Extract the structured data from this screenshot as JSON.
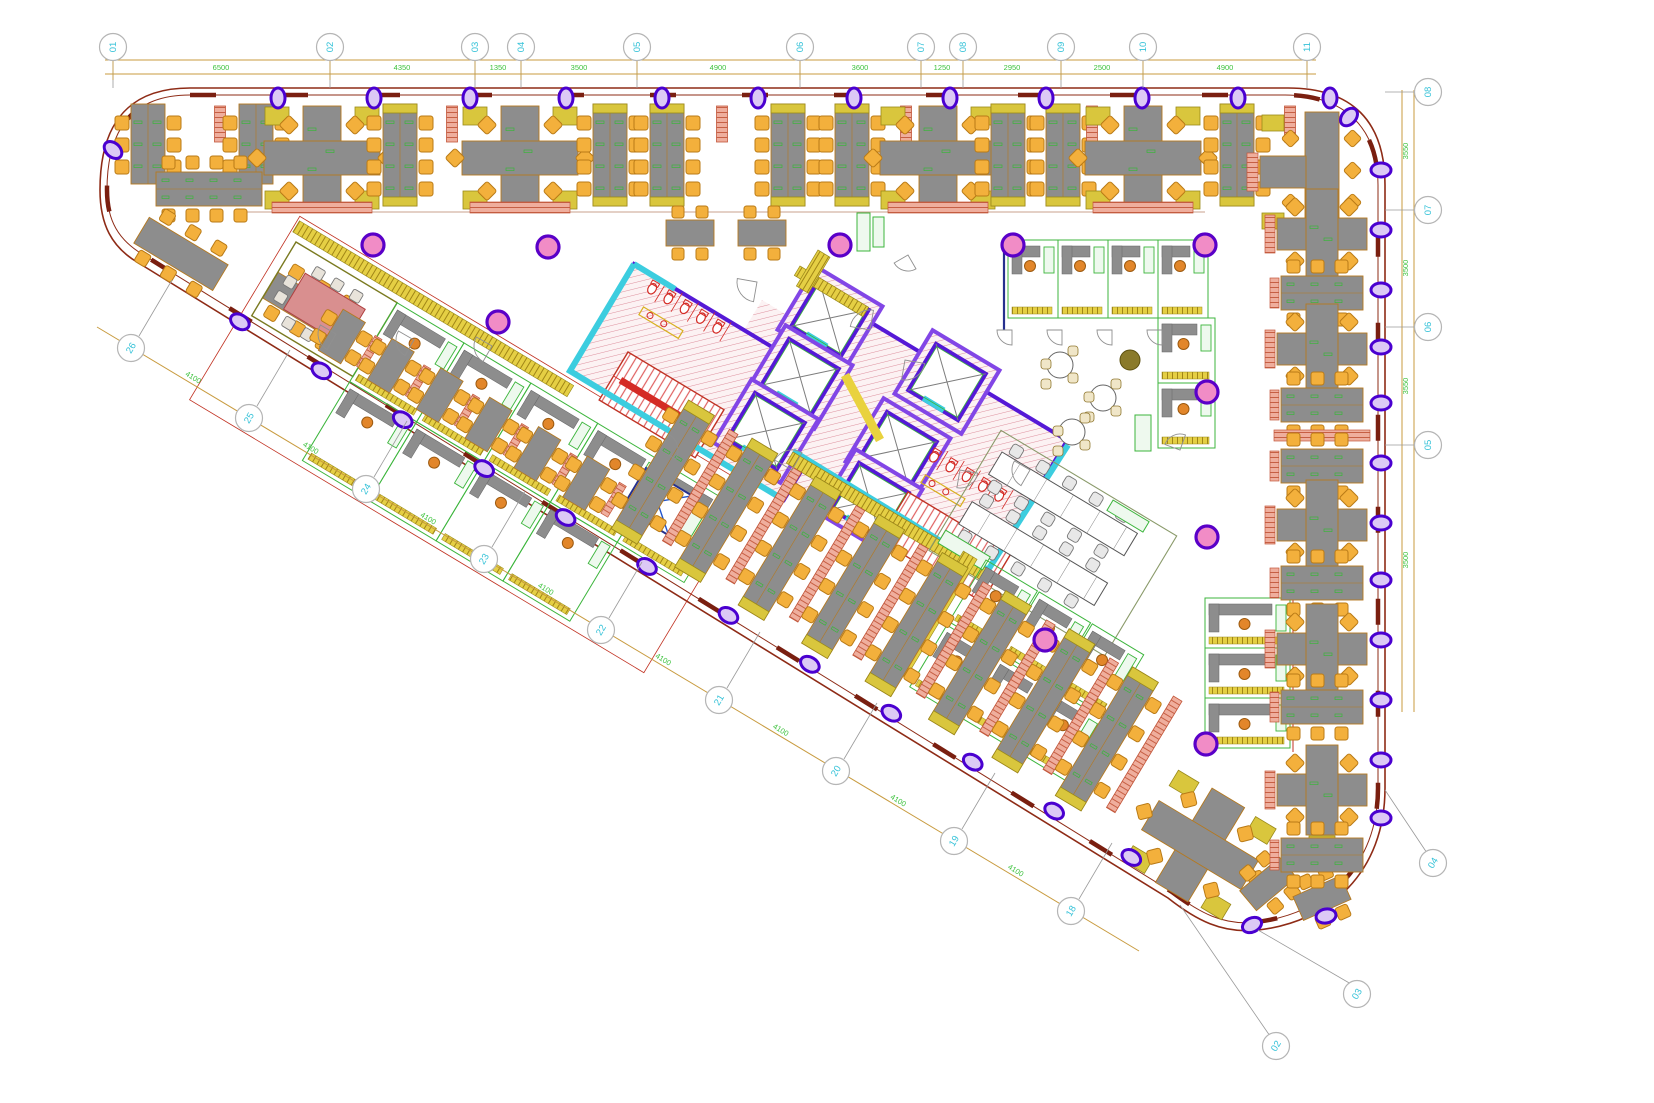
{
  "drawing": {
    "canvas": {
      "w": 1654,
      "h": 1103,
      "bg": "#ffffff"
    },
    "colors": {
      "wall": "#8e2b16",
      "wallDash": "#7a1f10",
      "doorArc": "#909090",
      "column": "#dcc9f5",
      "columnStroke": "#4a00d0",
      "pinkCol": "#f18cc6",
      "pinkColStroke": "#5a00c8",
      "desk": "#8d8d8d",
      "deskStroke": "#b5791f",
      "chair": "#f3b03c",
      "chairStroke": "#b97a16",
      "gold": "#d9c63d",
      "goldStroke": "#9a8a1a",
      "salmon": "#efae9d",
      "salmonStroke": "#c2563a",
      "green": "#3cb53c",
      "navy": "#26308e",
      "coreWall": "#5519d6",
      "coreWall2": "#8246e6",
      "hatchLine": "#dd8f9d",
      "hatchBg": "#fcf2f3",
      "cyan": "#3ccddf",
      "red": "#d42b25",
      "yellow": "#e9d23e",
      "dim": "#c89b3f",
      "dimText": "#3dc23d",
      "bubbleStroke": "#b5b5b5",
      "bubbleText": "#35c2d8",
      "boundary": "#c8a08e",
      "stairRed": "#d84040"
    },
    "structure": {
      "outline_outer": "M 190,88 L 1288,88 C 1352,88 1385,121 1385,185 L 1385,788 C 1385,872 1330,922 1258,930 C 1222,934 1196,920 1168,898 L 137,262 C 112,247 100,225 100,190 C 100,126 126,88 190,88 Z",
      "outline_inner": "M 190,95 L 1285,95 C 1345,95 1378,128 1378,185 L 1378,788 C 1378,866 1326,914 1256,922 C 1224,926 1200,913 1172,892 L 142,254 C 119,240 107,221 107,190 C 107,130 132,95 190,95 Z",
      "diag_wall": {
        "x1": 137,
        "y1": 260,
        "angle": 31
      },
      "band_boundary": {
        "x1": 235,
        "y1": 212,
        "x2": 1205,
        "y2": 212
      }
    },
    "grid": {
      "top": {
        "bubble_y": 47,
        "line_y1": 60,
        "line_y2": 74,
        "x_start": 105,
        "x_end": 1316,
        "bubbles": [
          {
            "label": "01",
            "x": 113
          },
          {
            "label": "02",
            "x": 330
          },
          {
            "label": "03",
            "x": 475
          },
          {
            "label": "04",
            "x": 521
          },
          {
            "label": "05",
            "x": 637
          },
          {
            "label": "06",
            "x": 800
          },
          {
            "label": "07",
            "x": 921
          },
          {
            "label": "08",
            "x": 963
          },
          {
            "label": "09",
            "x": 1061
          },
          {
            "label": "10",
            "x": 1143
          },
          {
            "label": "11",
            "x": 1307
          }
        ],
        "dims": [
          {
            "text": "6500",
            "x": 221
          },
          {
            "text": "4350",
            "x": 402
          },
          {
            "text": "1350",
            "x": 498
          },
          {
            "text": "3500",
            "x": 579
          },
          {
            "text": "4900",
            "x": 718
          },
          {
            "text": "3600",
            "x": 860
          },
          {
            "text": "1250",
            "x": 942
          },
          {
            "text": "2950",
            "x": 1012
          },
          {
            "text": "2500",
            "x": 1102
          },
          {
            "text": "4900",
            "x": 1225
          }
        ]
      },
      "right": {
        "bubble_x": 1428,
        "line_x1": 1402,
        "line_x2": 1414,
        "y_start": 90,
        "y_end": 712,
        "bubbles": [
          {
            "label": "08",
            "y": 92
          },
          {
            "label": "07",
            "y": 210
          },
          {
            "label": "06",
            "y": 327
          },
          {
            "label": "05",
            "y": 445
          }
        ],
        "dims": [
          {
            "text": "3550",
            "y": 151
          },
          {
            "text": "3500",
            "y": 268
          },
          {
            "text": "3550",
            "y": 386
          },
          {
            "text": "3500",
            "y": 560
          }
        ]
      },
      "diagonal": {
        "line": {
          "x1": 97,
          "y1": 327,
          "x2": 1139,
          "y2": 951
        },
        "dim_text": "4100",
        "bubbles": [
          {
            "label": "26",
            "x": 131,
            "y": 348
          },
          {
            "label": "25",
            "x": 249,
            "y": 418
          },
          {
            "label": "24",
            "x": 366,
            "y": 489
          },
          {
            "label": "23",
            "x": 484,
            "y": 559
          },
          {
            "label": "22",
            "x": 601,
            "y": 630
          },
          {
            "label": "21",
            "x": 719,
            "y": 700
          },
          {
            "label": "20",
            "x": 836,
            "y": 771
          },
          {
            "label": "19",
            "x": 954,
            "y": 841
          },
          {
            "label": "18",
            "x": 1071,
            "y": 911
          }
        ]
      },
      "corner_bubbles": [
        {
          "label": "04",
          "x": 1433,
          "y": 863
        },
        {
          "label": "03",
          "x": 1357,
          "y": 994
        },
        {
          "label": "02",
          "x": 1276,
          "y": 1046
        }
      ]
    },
    "columns": {
      "top": {
        "y": 98,
        "xs": [
          278,
          374,
          470,
          566,
          662,
          758,
          854,
          950,
          1046,
          1142,
          1238,
          1330
        ]
      },
      "right": {
        "x": 1381,
        "ys": [
          170,
          230,
          290,
          347,
          403,
          463,
          523,
          580,
          640,
          700,
          760,
          818
        ]
      },
      "diag_ts": [
        120,
        215,
        310,
        405,
        500,
        595,
        690,
        785,
        880,
        975,
        1070,
        1160
      ],
      "extra": [
        [
          113,
          150,
          -48
        ],
        [
          1349,
          117,
          42
        ],
        [
          1252,
          925,
          65
        ],
        [
          1326,
          916,
          80
        ]
      ]
    },
    "pink_columns": [
      [
        373,
        245
      ],
      [
        548,
        247
      ],
      [
        498,
        322
      ],
      [
        840,
        245
      ],
      [
        1013,
        245
      ],
      [
        1205,
        245
      ],
      [
        1207,
        392
      ],
      [
        1207,
        537
      ],
      [
        1045,
        640
      ],
      [
        1206,
        744
      ]
    ],
    "top_band": {
      "base_y": 104,
      "clusters": [
        {
          "x": 148,
          "t": "v6"
        },
        {
          "x": 220,
          "t": "p"
        },
        {
          "x": 256,
          "t": "v6"
        },
        {
          "x": 322,
          "t": "T"
        },
        {
          "x": 400,
          "t": "v8"
        },
        {
          "x": 452,
          "t": "p"
        },
        {
          "x": 520,
          "t": "T"
        },
        {
          "x": 610,
          "t": "v8"
        },
        {
          "x": 667,
          "t": "v8"
        },
        {
          "x": 722,
          "t": "p"
        },
        {
          "x": 788,
          "t": "v8"
        },
        {
          "x": 852,
          "t": "v8"
        },
        {
          "x": 906,
          "t": "p"
        },
        {
          "x": 938,
          "t": "T"
        },
        {
          "x": 1008,
          "t": "v8"
        },
        {
          "x": 1063,
          "t": "v8"
        },
        {
          "x": 1092,
          "t": "p"
        },
        {
          "x": 1143,
          "t": "T"
        },
        {
          "x": 1237,
          "t": "v8"
        },
        {
          "x": 1290,
          "t": "p"
        }
      ]
    },
    "left_tip": {
      "table": {
        "x": 161,
        "y": 189
      },
      "angled_rows": [
        {
          "x": 158,
          "y": 232,
          "rot": 31
        },
        {
          "x": 287,
          "y": 287,
          "rot": 31
        }
      ]
    },
    "scatter_desks": [
      {
        "x": 690,
        "y": 232
      },
      {
        "x": 762,
        "y": 232
      }
    ],
    "green_cabinets": [
      [
        857,
        213,
        13,
        38
      ],
      [
        873,
        217,
        11,
        30
      ]
    ],
    "left_block": {
      "x": 296,
      "y": 242,
      "rot": 31,
      "meeting": {
        "w": 118,
        "h": 86
      },
      "offices_row1": [
        118,
        196,
        274,
        352,
        430
      ],
      "offices_row2": [
        118,
        196,
        274,
        352
      ],
      "office_w": 78,
      "office_h": 92
    },
    "elv_room": {
      "x": 646,
      "y": 468,
      "rot": 31,
      "w": 54,
      "h": 46
    },
    "core": {
      "rot": 31,
      "block1": {
        "x": 634,
        "y": 264,
        "w": 250,
        "h": 125
      },
      "lobby": {
        "x": 762,
        "y": 300,
        "w": 150,
        "h": 150
      },
      "block2": {
        "x": 870,
        "y": 322,
        "w": 230,
        "h": 150
      },
      "shafts": [
        [
          830,
          318
        ],
        [
          800,
          377
        ],
        [
          766,
          431
        ],
        [
          947,
          382
        ],
        [
          898,
          450
        ],
        [
          870,
          501
        ]
      ],
      "stairs": [
        {
          "x": 628,
          "y": 352,
          "w": 112,
          "h": 56
        },
        {
          "x": 908,
          "y": 492,
          "w": 120,
          "h": 56
        }
      ],
      "toilets": [
        {
          "x": 648,
          "y": 284,
          "n": 5
        },
        {
          "x": 930,
          "y": 452,
          "n": 5
        }
      ],
      "gold_strips": [
        [
          793,
          452,
          232,
          13
        ],
        [
          800,
          266,
          80,
          11
        ],
        [
          818,
          250,
          14,
          42
        ]
      ],
      "yellow_stripe": {
        "x1": 845,
        "y1": 375,
        "x2": 880,
        "y2": 440
      }
    },
    "right_offices": {
      "top_row": {
        "y": 240,
        "h": 78,
        "w": 50,
        "xs": [
          1008,
          1058,
          1108,
          1158
        ]
      },
      "right_col": {
        "x": 1158,
        "w": 57,
        "h": 65,
        "ys": [
          318,
          383
        ]
      },
      "offices_B": {
        "x": 1205,
        "w": 85,
        "h": 50,
        "ys": [
          598,
          648,
          698
        ]
      }
    },
    "training": {
      "x": 1002,
      "y": 452,
      "rot": 31
    },
    "break_area": {
      "tables": [
        [
          1060,
          365
        ],
        [
          1103,
          398
        ],
        [
          1072,
          432
        ]
      ],
      "dark_table": [
        1130,
        360
      ],
      "cabinet": [
        1135,
        415,
        16,
        36
      ]
    },
    "lower_offices": {
      "x": 986,
      "y": 560,
      "rot": 31,
      "row1": [
        0,
        62,
        124
      ],
      "row2": [
        0,
        62,
        124
      ],
      "w": 60,
      "h": 72
    },
    "diag_band": {
      "offset": 14,
      "small_ts": [
        215,
        272,
        329,
        386,
        443,
        500
      ],
      "row_ts": [
        560,
        634,
        708,
        782,
        856,
        930,
        1004,
        1078
      ],
      "row_len": 150,
      "end_T": {
        "x": 1200,
        "y": 845,
        "rot": 31
      },
      "corner_desks": [
        {
          "x": 1268,
          "y": 884,
          "rot": 50
        },
        {
          "x": 1322,
          "y": 898,
          "rot": 66
        }
      ]
    },
    "right_band": {
      "x": 1322,
      "clusters": [
        {
          "y": 172,
          "t": "T"
        },
        {
          "y": 234,
          "t": "cross"
        },
        {
          "y": 293,
          "t": "h6"
        },
        {
          "y": 349,
          "t": "cross"
        },
        {
          "y": 405,
          "t": "h6"
        },
        {
          "y": 436,
          "t": "p"
        },
        {
          "y": 466,
          "t": "h6"
        },
        {
          "y": 525,
          "t": "cross"
        },
        {
          "y": 583,
          "t": "h6"
        },
        {
          "y": 649,
          "t": "cross"
        },
        {
          "y": 707,
          "t": "h6"
        },
        {
          "y": 790,
          "t": "cross"
        },
        {
          "y": 855,
          "t": "h6"
        }
      ]
    },
    "doors": [
      [
        757,
        282,
        20,
        100
      ],
      [
        870,
        330,
        20,
        190
      ],
      [
        905,
        360,
        20,
        10
      ],
      [
        792,
        470,
        20,
        210
      ],
      [
        960,
        470,
        18,
        10
      ],
      [
        1030,
        470,
        18,
        120
      ],
      [
        660,
        450,
        18,
        300
      ],
      [
        1012,
        330,
        15,
        90
      ],
      [
        1062,
        330,
        15,
        90
      ],
      [
        1112,
        330,
        15,
        90
      ],
      [
        1162,
        330,
        15,
        90
      ],
      [
        336,
        334,
        18,
        120
      ],
      [
        414,
        340,
        18,
        120
      ],
      [
        492,
        346,
        18,
        120
      ],
      [
        908,
        255,
        16,
        60
      ],
      [
        1180,
        450,
        16,
        200
      ]
    ]
  }
}
